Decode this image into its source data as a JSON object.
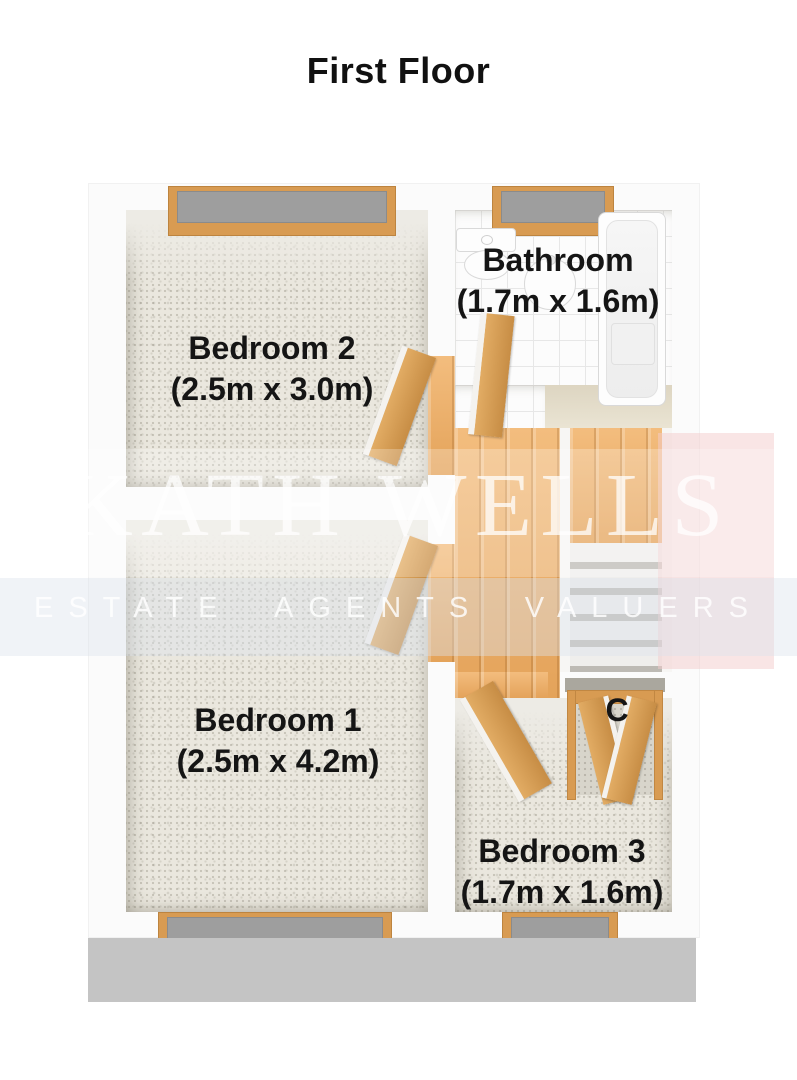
{
  "title": "First Floor",
  "rooms": [
    {
      "name": "Bedroom 2",
      "dims": "(2.5m x 3.0m)",
      "floor": "carpet"
    },
    {
      "name": "Bathroom",
      "dims": "(1.7m x 1.6m)",
      "floor": "tile"
    },
    {
      "name": "Bedroom 1",
      "dims": "(2.5m x 4.2m)",
      "floor": "carpet"
    },
    {
      "name": "Bedroom 3",
      "dims": "(1.7m x 1.6m)",
      "floor": "carpet"
    },
    {
      "name": "C",
      "floor": "carpet"
    }
  ],
  "watermark": {
    "name": "KATH WELLS",
    "tagline_words": [
      "ESTATE",
      "AGENTS",
      "VALUERS"
    ]
  },
  "colors": {
    "wall": "#fbfbfb",
    "wall_face2": "#edebe5",
    "wall_shadow": "#c4c4c4",
    "carpet": "#eae7de",
    "wood": "#eeb273",
    "wood_dark": "#d89b52",
    "glass": "#9e9e9e",
    "tile": "#fcfcfc",
    "tile_line": "#e7e7e7",
    "step": "#efeeec",
    "step_edge": "#bdbab4",
    "label": "#151515",
    "wm_text": "rgba(255,255,255,0.75)",
    "wm_band": "rgba(255,255,255,0.25)",
    "wm_band2": "rgba(219,226,236,0.42)",
    "wm_pink": "rgba(244,203,203,0.5)"
  }
}
